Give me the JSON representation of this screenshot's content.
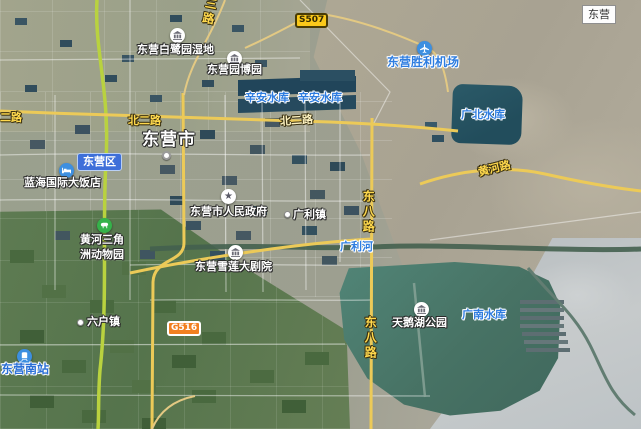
{
  "map_title": "东营",
  "city_label": "东营市",
  "district_badge": "东营区",
  "road_badges": {
    "s507": "S507",
    "g516": "G516"
  },
  "road_labels": {
    "sanlu": "三路",
    "erlu_left": "二路",
    "beierlu_mid": "北二路",
    "beierlu_right": "北二路",
    "dongbalu_upper": "东八路",
    "dongbalu_lower": "东八路",
    "huanghelu": "黄河路"
  },
  "water_labels": {
    "xinan_left": "辛安水库",
    "xinan_right": "辛安水库",
    "guangbei": "广北水库",
    "guangnan": "广南水库",
    "guanglihe": "广利河"
  },
  "poi_labels": {
    "bailuyuan": "东营白鹭园湿地",
    "yuanboyuan": "东营园博园",
    "airport": "东营胜利机场",
    "hotel": "蓝海国际大饭店",
    "government": "东营市人民政府",
    "guanglizhen": "广利镇",
    "zoo_line1": "黄河三角",
    "zoo_line2": "洲动物园",
    "theater": "东营雪莲大剧院",
    "liuhuzhen": "六户镇",
    "south_station": "东营南站",
    "swan_lake": "天鹅湖公园"
  },
  "colors": {
    "water_label": "#2e7de0",
    "road_label_yellow": "#ffd94d",
    "district_badge_bg": "#3e6fd9",
    "s507_badge_bg": "#fbc91a",
    "g516_badge_bg": "#f28021",
    "expressway_green": "#b9d23f",
    "road_yellow": "#ecca58",
    "reservoir_dark": "#25525f",
    "reservoir_teal": "#477264"
  }
}
